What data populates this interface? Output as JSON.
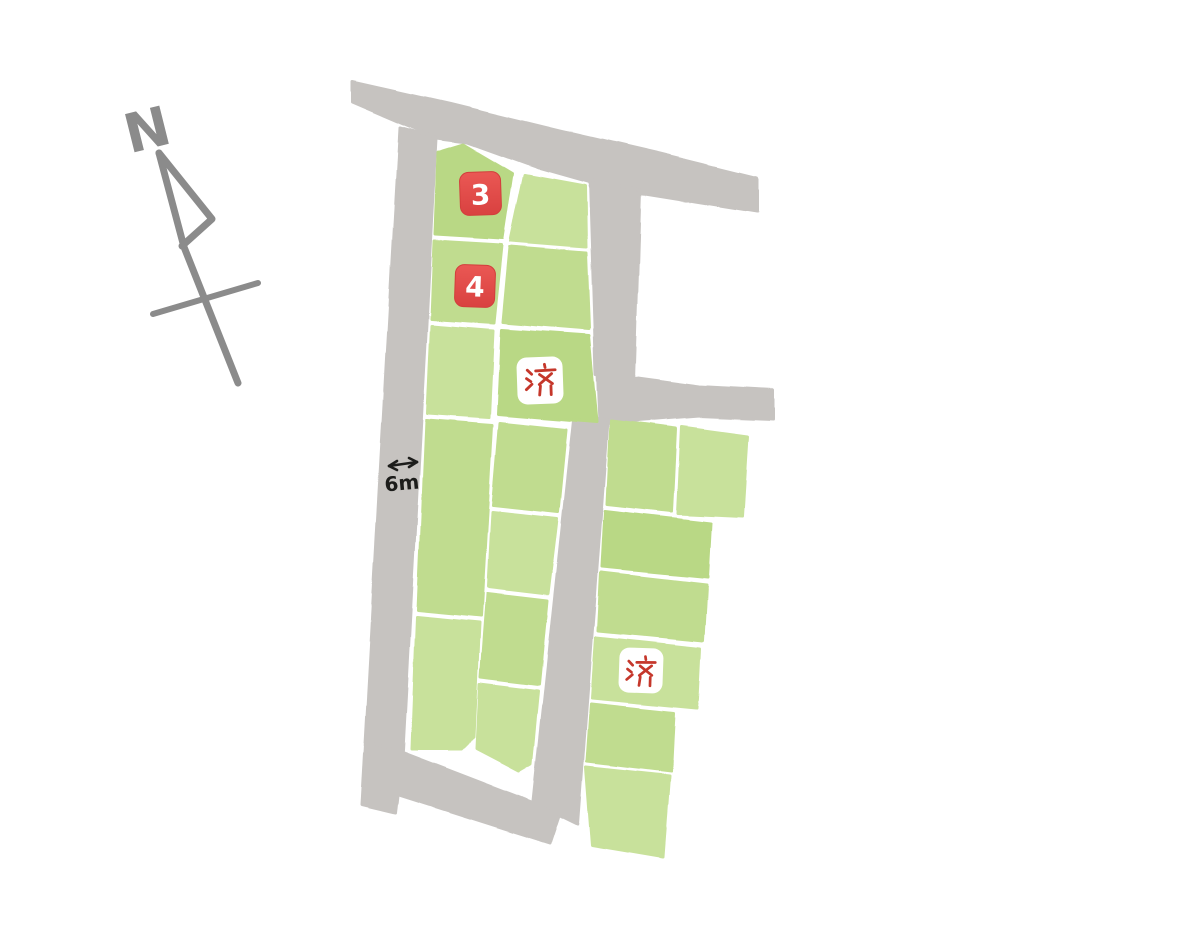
{
  "map": {
    "compass_label": "N",
    "road_width_label": "6m",
    "sold_label": "済",
    "available_lots": [
      {
        "number": "3"
      },
      {
        "number": "4"
      }
    ],
    "sold_lots_count": 2,
    "total_lots": 19
  },
  "colors": {
    "lot_green": "#c0dc8f",
    "road_gray": "#c6c3c0",
    "badge_red": "#e34f4b",
    "sold_red": "#c5372b",
    "compass_gray": "#8b8b8b",
    "ink_black": "#1d1d1b",
    "background": "#ffffff"
  }
}
